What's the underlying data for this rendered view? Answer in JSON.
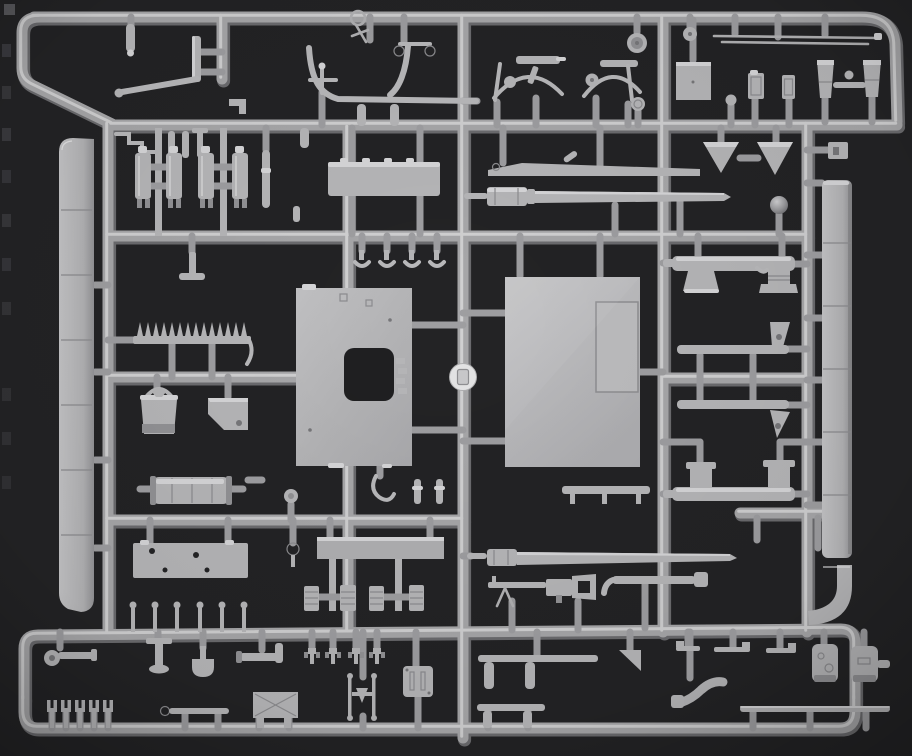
{
  "scene": {
    "type": "photograph",
    "subject": "Injection-molded light grey plastic model kit sprue (parts tree) photographed on a dark background, with dozens of unassembled styrene parts attached to a rectangular runner frame",
    "background": "dark charcoal",
    "plastic": "light grey styrene"
  },
  "palette": {
    "background": "#232325",
    "runner_base": "#a7a7a9",
    "runner_highlight": "#d8d8d9",
    "runner_shadow": "#6b6b6e",
    "part_base": "#b6b6b8",
    "part_light": "#e9e9ea",
    "part_dark": "#77777a",
    "mold_disc": "#e4e4e5"
  },
  "sprue": {
    "frame": {
      "shape": "rectangular grid with rounded corners and chamfered top-left corner",
      "rows": 6,
      "columns": 5
    },
    "mold_circle_mark": {
      "shape": "bright disc with rectangular recess",
      "position": "center of middle runner"
    },
    "parts": [
      {
        "name": "candle-pin-top-left",
        "region": "top-left"
      },
      {
        "name": "mounting-post",
        "region": "top-left"
      },
      {
        "name": "tow-bar-rod",
        "region": "top-left"
      },
      {
        "name": "crank-and-pins-cluster",
        "region": "top-left"
      },
      {
        "name": "corner-bracket",
        "region": "top-left"
      },
      {
        "name": "grab-rail-curved",
        "region": "top"
      },
      {
        "name": "valve-cross-part",
        "region": "top"
      },
      {
        "name": "eyelet-bracket",
        "region": "top"
      },
      {
        "name": "hand-wheel-part",
        "region": "top"
      },
      {
        "name": "mg-aa-mount-left",
        "region": "top"
      },
      {
        "name": "mg-aa-mount-right",
        "region": "top"
      },
      {
        "name": "road-wheel-large",
        "region": "top-right"
      },
      {
        "name": "road-wheel-small",
        "region": "top-right"
      },
      {
        "name": "pressure-gauge-part",
        "region": "top-right"
      },
      {
        "name": "antenna-rods",
        "region": "top-right"
      },
      {
        "name": "hatch-square-plate",
        "region": "top-right"
      },
      {
        "name": "knob-ball-part",
        "region": "top-right"
      },
      {
        "name": "canister-left",
        "region": "top-right"
      },
      {
        "name": "canister-right",
        "region": "top-right"
      },
      {
        "name": "muffler-left",
        "region": "top-right"
      },
      {
        "name": "muffler-right",
        "region": "top-right"
      },
      {
        "name": "crossbar-with-knob",
        "region": "top-right"
      },
      {
        "name": "triangle-plate-left",
        "region": "right"
      },
      {
        "name": "triangle-plate-right",
        "region": "right"
      },
      {
        "name": "latch-box-part",
        "region": "right-edge"
      },
      {
        "name": "right-fender-strip",
        "region": "right-edge"
      },
      {
        "name": "right-fender-curve",
        "region": "right-edge"
      },
      {
        "name": "shift-ball-part",
        "region": "right"
      },
      {
        "name": "fuel-filter-cylinders",
        "region": "upper-left"
      },
      {
        "name": "stowage-lid-plate",
        "region": "upper-center"
      },
      {
        "name": "hanging-candle-part",
        "region": "upper-center"
      },
      {
        "name": "wiper-linkage-arm",
        "region": "upper-center"
      },
      {
        "name": "gun-barrel-upper",
        "region": "upper-center"
      },
      {
        "name": "left-fender-strip",
        "region": "left-edge"
      },
      {
        "name": "tee-handle-part",
        "region": "left"
      },
      {
        "name": "tooth-rack-part",
        "region": "left"
      },
      {
        "name": "bucket-part",
        "region": "left"
      },
      {
        "name": "corner-plate-part",
        "region": "left"
      },
      {
        "name": "fuel-drum-part",
        "region": "left"
      },
      {
        "name": "hatch-panel-with-cutout",
        "region": "center"
      },
      {
        "name": "hull-roof-panel",
        "region": "center"
      },
      {
        "name": "inset-hatch-lid",
        "region": "center"
      },
      {
        "name": "mold-circle-mark",
        "region": "center"
      },
      {
        "name": "clamp-parts-row",
        "region": "center"
      },
      {
        "name": "chain-hook-part",
        "region": "center"
      },
      {
        "name": "rifle-pin-parts",
        "region": "center"
      },
      {
        "name": "bench-bracket-part",
        "region": "center"
      },
      {
        "name": "gun-tube-with-pedestals-upper",
        "region": "right"
      },
      {
        "name": "support-rod-with-wedge-upper",
        "region": "right"
      },
      {
        "name": "support-rod-with-wedge-lower",
        "region": "right"
      },
      {
        "name": "gun-tube-with-pedestals-lower",
        "region": "right"
      },
      {
        "name": "stowage-plate-with-holes",
        "region": "lower-left"
      },
      {
        "name": "flat-plate-part",
        "region": "lower-center"
      },
      {
        "name": "ring-pull-part",
        "region": "lower-left"
      },
      {
        "name": "small-gauge-part",
        "region": "lower-left"
      },
      {
        "name": "stacked-links-parts",
        "region": "lower-center"
      },
      {
        "name": "barrel-with-muzzle-brake",
        "region": "lower-center"
      },
      {
        "name": "machine-gun-mg",
        "region": "lower-center"
      },
      {
        "name": "elbow-pipe-part",
        "region": "lower-center"
      },
      {
        "name": "pin-row-parts",
        "region": "lower-left"
      },
      {
        "name": "wedge-arrow-part",
        "region": "bottom"
      },
      {
        "name": "periscope-bar-parts",
        "region": "bottom-right"
      },
      {
        "name": "drive-housing-left",
        "region": "bottom-right"
      },
      {
        "name": "drive-housing-right",
        "region": "bottom-right"
      },
      {
        "name": "exhaust-elbow-part",
        "region": "bottom-right"
      },
      {
        "name": "thin-rod-bottom",
        "region": "bottom-right"
      },
      {
        "name": "discharger-bar-upper",
        "region": "bottom-center"
      },
      {
        "name": "discharger-bar-lower",
        "region": "bottom-center"
      },
      {
        "name": "clamp-pin-parts",
        "region": "bottom-center"
      },
      {
        "name": "twin-rod-antenna-base",
        "region": "bottom-center"
      },
      {
        "name": "slotted-plate-part",
        "region": "bottom-center"
      },
      {
        "name": "bar-with-cap-part",
        "region": "bottom-left"
      },
      {
        "name": "jack-tool-part",
        "region": "bottom-left"
      },
      {
        "name": "shovel-part",
        "region": "bottom-left"
      },
      {
        "name": "towing-clevis-part",
        "region": "bottom-left"
      },
      {
        "name": "shackle-forks-row",
        "region": "bottom-left"
      },
      {
        "name": "eyelet-rod-part",
        "region": "bottom-left"
      },
      {
        "name": "crossed-brace-panel",
        "region": "bottom-left"
      }
    ]
  }
}
